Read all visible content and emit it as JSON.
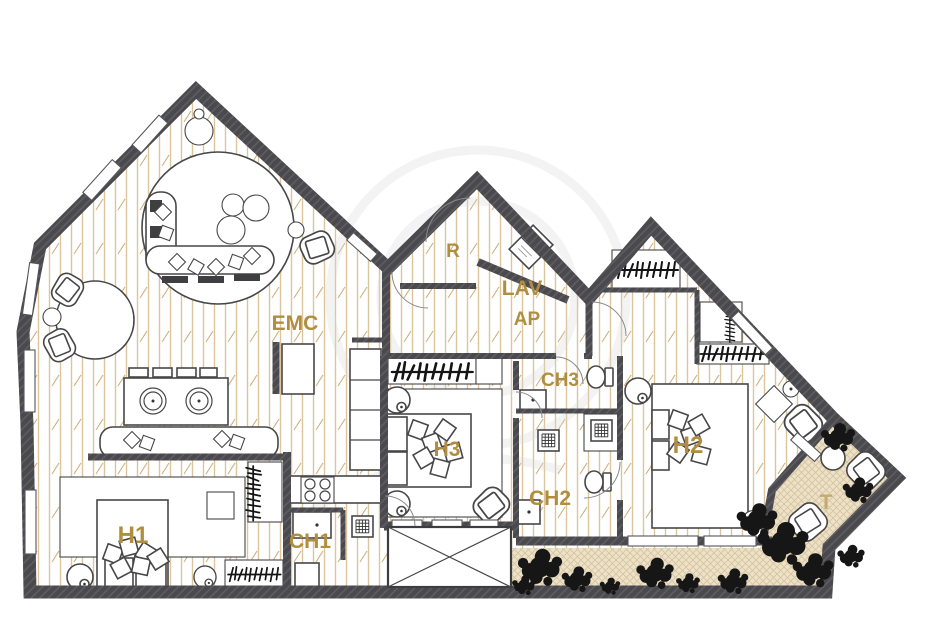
{
  "rooms": {
    "emc": {
      "label": "EMC"
    },
    "r": {
      "label": "R"
    },
    "lav": {
      "label": "LAV"
    },
    "ap": {
      "label": "AP"
    },
    "ch1": {
      "label": "CH1"
    },
    "ch2": {
      "label": "CH2"
    },
    "ch3": {
      "label": "CH3"
    },
    "h1": {
      "label": "H1"
    },
    "h2": {
      "label": "H2"
    },
    "h3": {
      "label": "H3"
    },
    "t": {
      "label": "T"
    }
  },
  "colors": {
    "wall": "#4a4a4e",
    "label": "#b18e3f",
    "terrace_label": "#c5aa6d",
    "wood_line": "#dcc49c",
    "wood_tick": "#cdb17e",
    "terrace_bg": "#ece1c9",
    "terrace_line": "#d7c5a0",
    "plant": "#161616",
    "furniture_stroke": "#474747"
  }
}
